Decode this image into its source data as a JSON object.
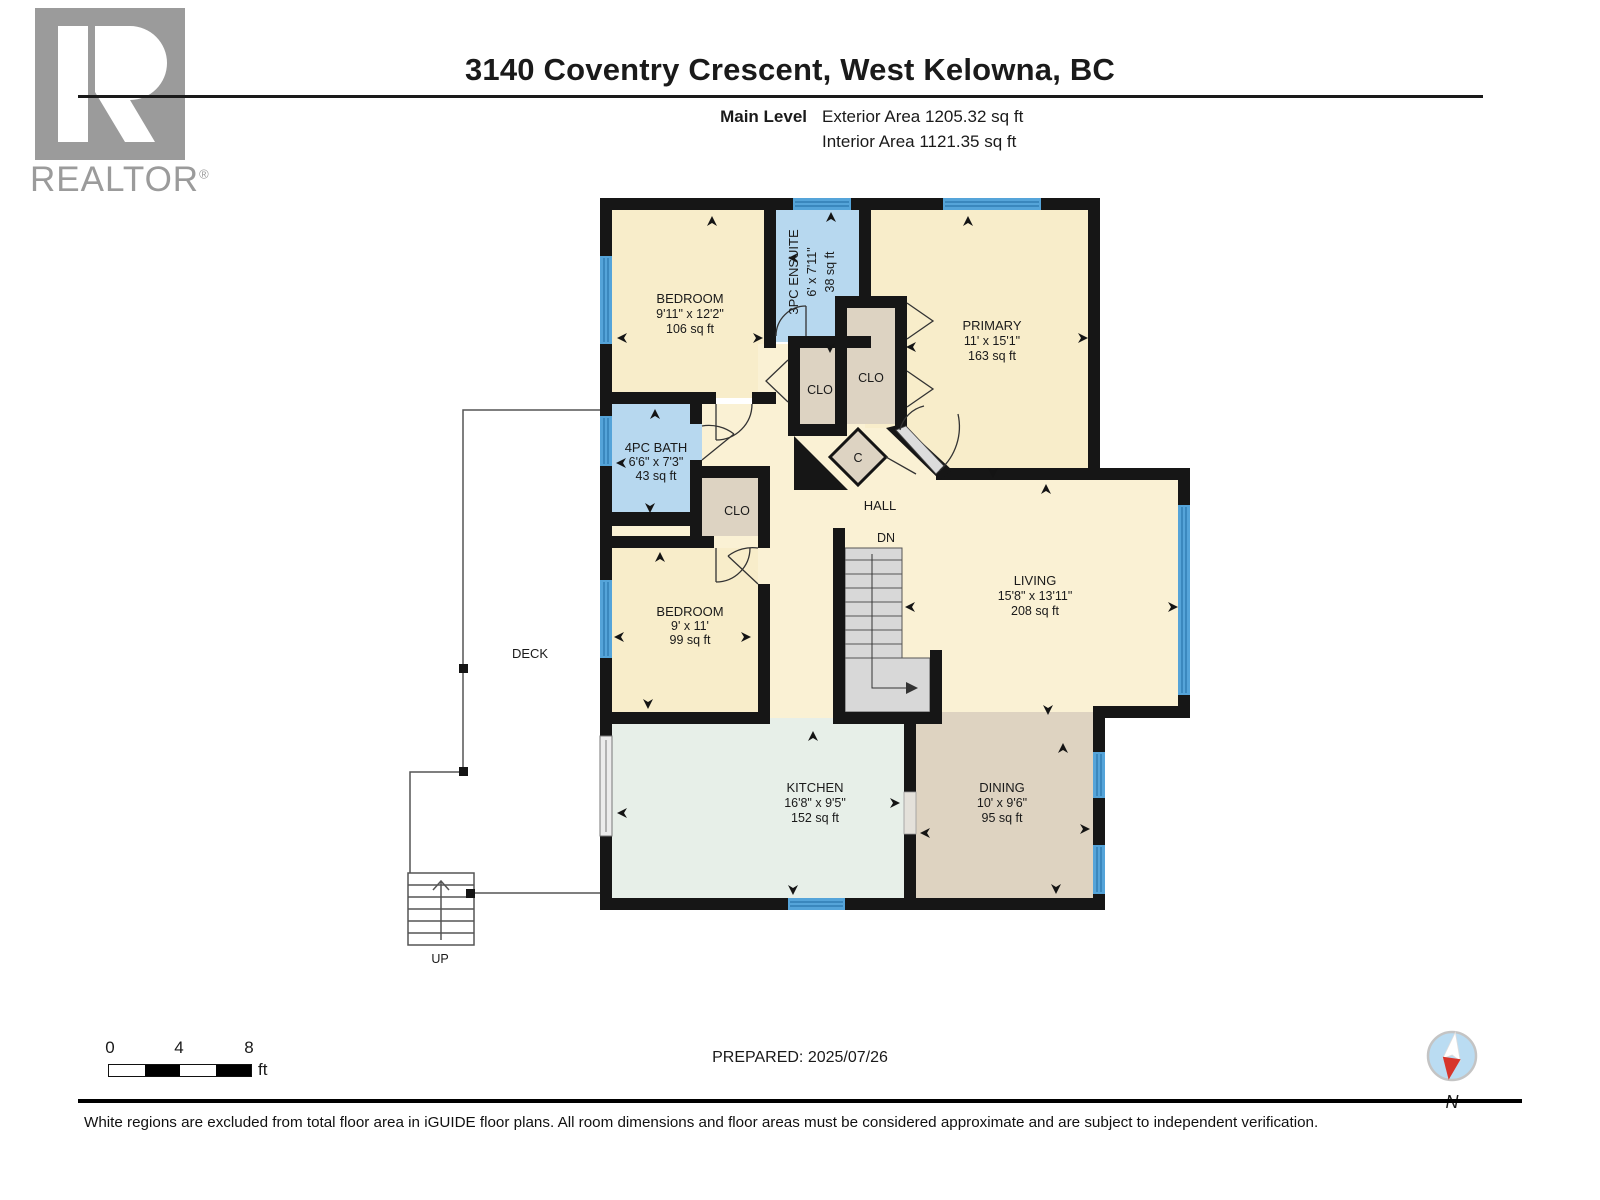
{
  "header": {
    "title": "3140 Coventry Crescent, West Kelowna, BC",
    "level_label": "Main Level",
    "exterior_area": "Exterior Area 1205.32 sq ft",
    "interior_area": "Interior Area 1121.35 sq ft",
    "logo_text": "REALTOR",
    "logo_reg": "®"
  },
  "rooms": {
    "bedroom1": {
      "name": "BEDROOM",
      "dims": "9'11\" x 12'2\"",
      "area": "106 sq ft"
    },
    "ensuite": {
      "name": "3PC ENSUITE",
      "dims": "6' x 7'11\"",
      "area": "38 sq ft"
    },
    "primary": {
      "name": "PRIMARY",
      "dims": "11' x 15'1\"",
      "area": "163 sq ft"
    },
    "bath": {
      "name": "4PC BATH",
      "dims": "6'6\" x 7'3\"",
      "area": "43 sq ft"
    },
    "bedroom2": {
      "name": "BEDROOM",
      "dims": "9' x 11'",
      "area": "99 sq ft"
    },
    "living": {
      "name": "LIVING",
      "dims": "15'8\" x 13'11\"",
      "area": "208 sq ft"
    },
    "kitchen": {
      "name": "KITCHEN",
      "dims": "16'8\" x 9'5\"",
      "area": "152 sq ft"
    },
    "dining": {
      "name": "DINING",
      "dims": "10' x 9'6\"",
      "area": "95 sq ft"
    },
    "hall": "HALL",
    "deck": "DECK",
    "closet": "CLO",
    "closet_small": "C",
    "stairs_down": "DN",
    "stairs_up": "UP"
  },
  "scale_bar": {
    "tick0": "0",
    "tick4": "4",
    "tick8": "8",
    "unit": "ft"
  },
  "footer": {
    "prepared": "PREPARED: 2025/07/26",
    "compass_north": "N",
    "disclaimer": "White regions are excluded from total floor area in iGUIDE floor plans. All room dimensions and floor areas must be considered approximate and are subject to independent verification."
  },
  "colors": {
    "wall": "#161616",
    "room_cream": "#f8edca",
    "bath_blue": "#b7d8ef",
    "closet_tan": "#ddd3c2",
    "kitchen_mint": "#e7efe8",
    "dining_tan": "#ded3c1",
    "window_blue": "#55a4d9",
    "stairs_gray": "#d8d8d8",
    "logo_gray": "#9b9b9b",
    "compass_red": "#d7352b",
    "compass_blue": "#badcf2"
  }
}
